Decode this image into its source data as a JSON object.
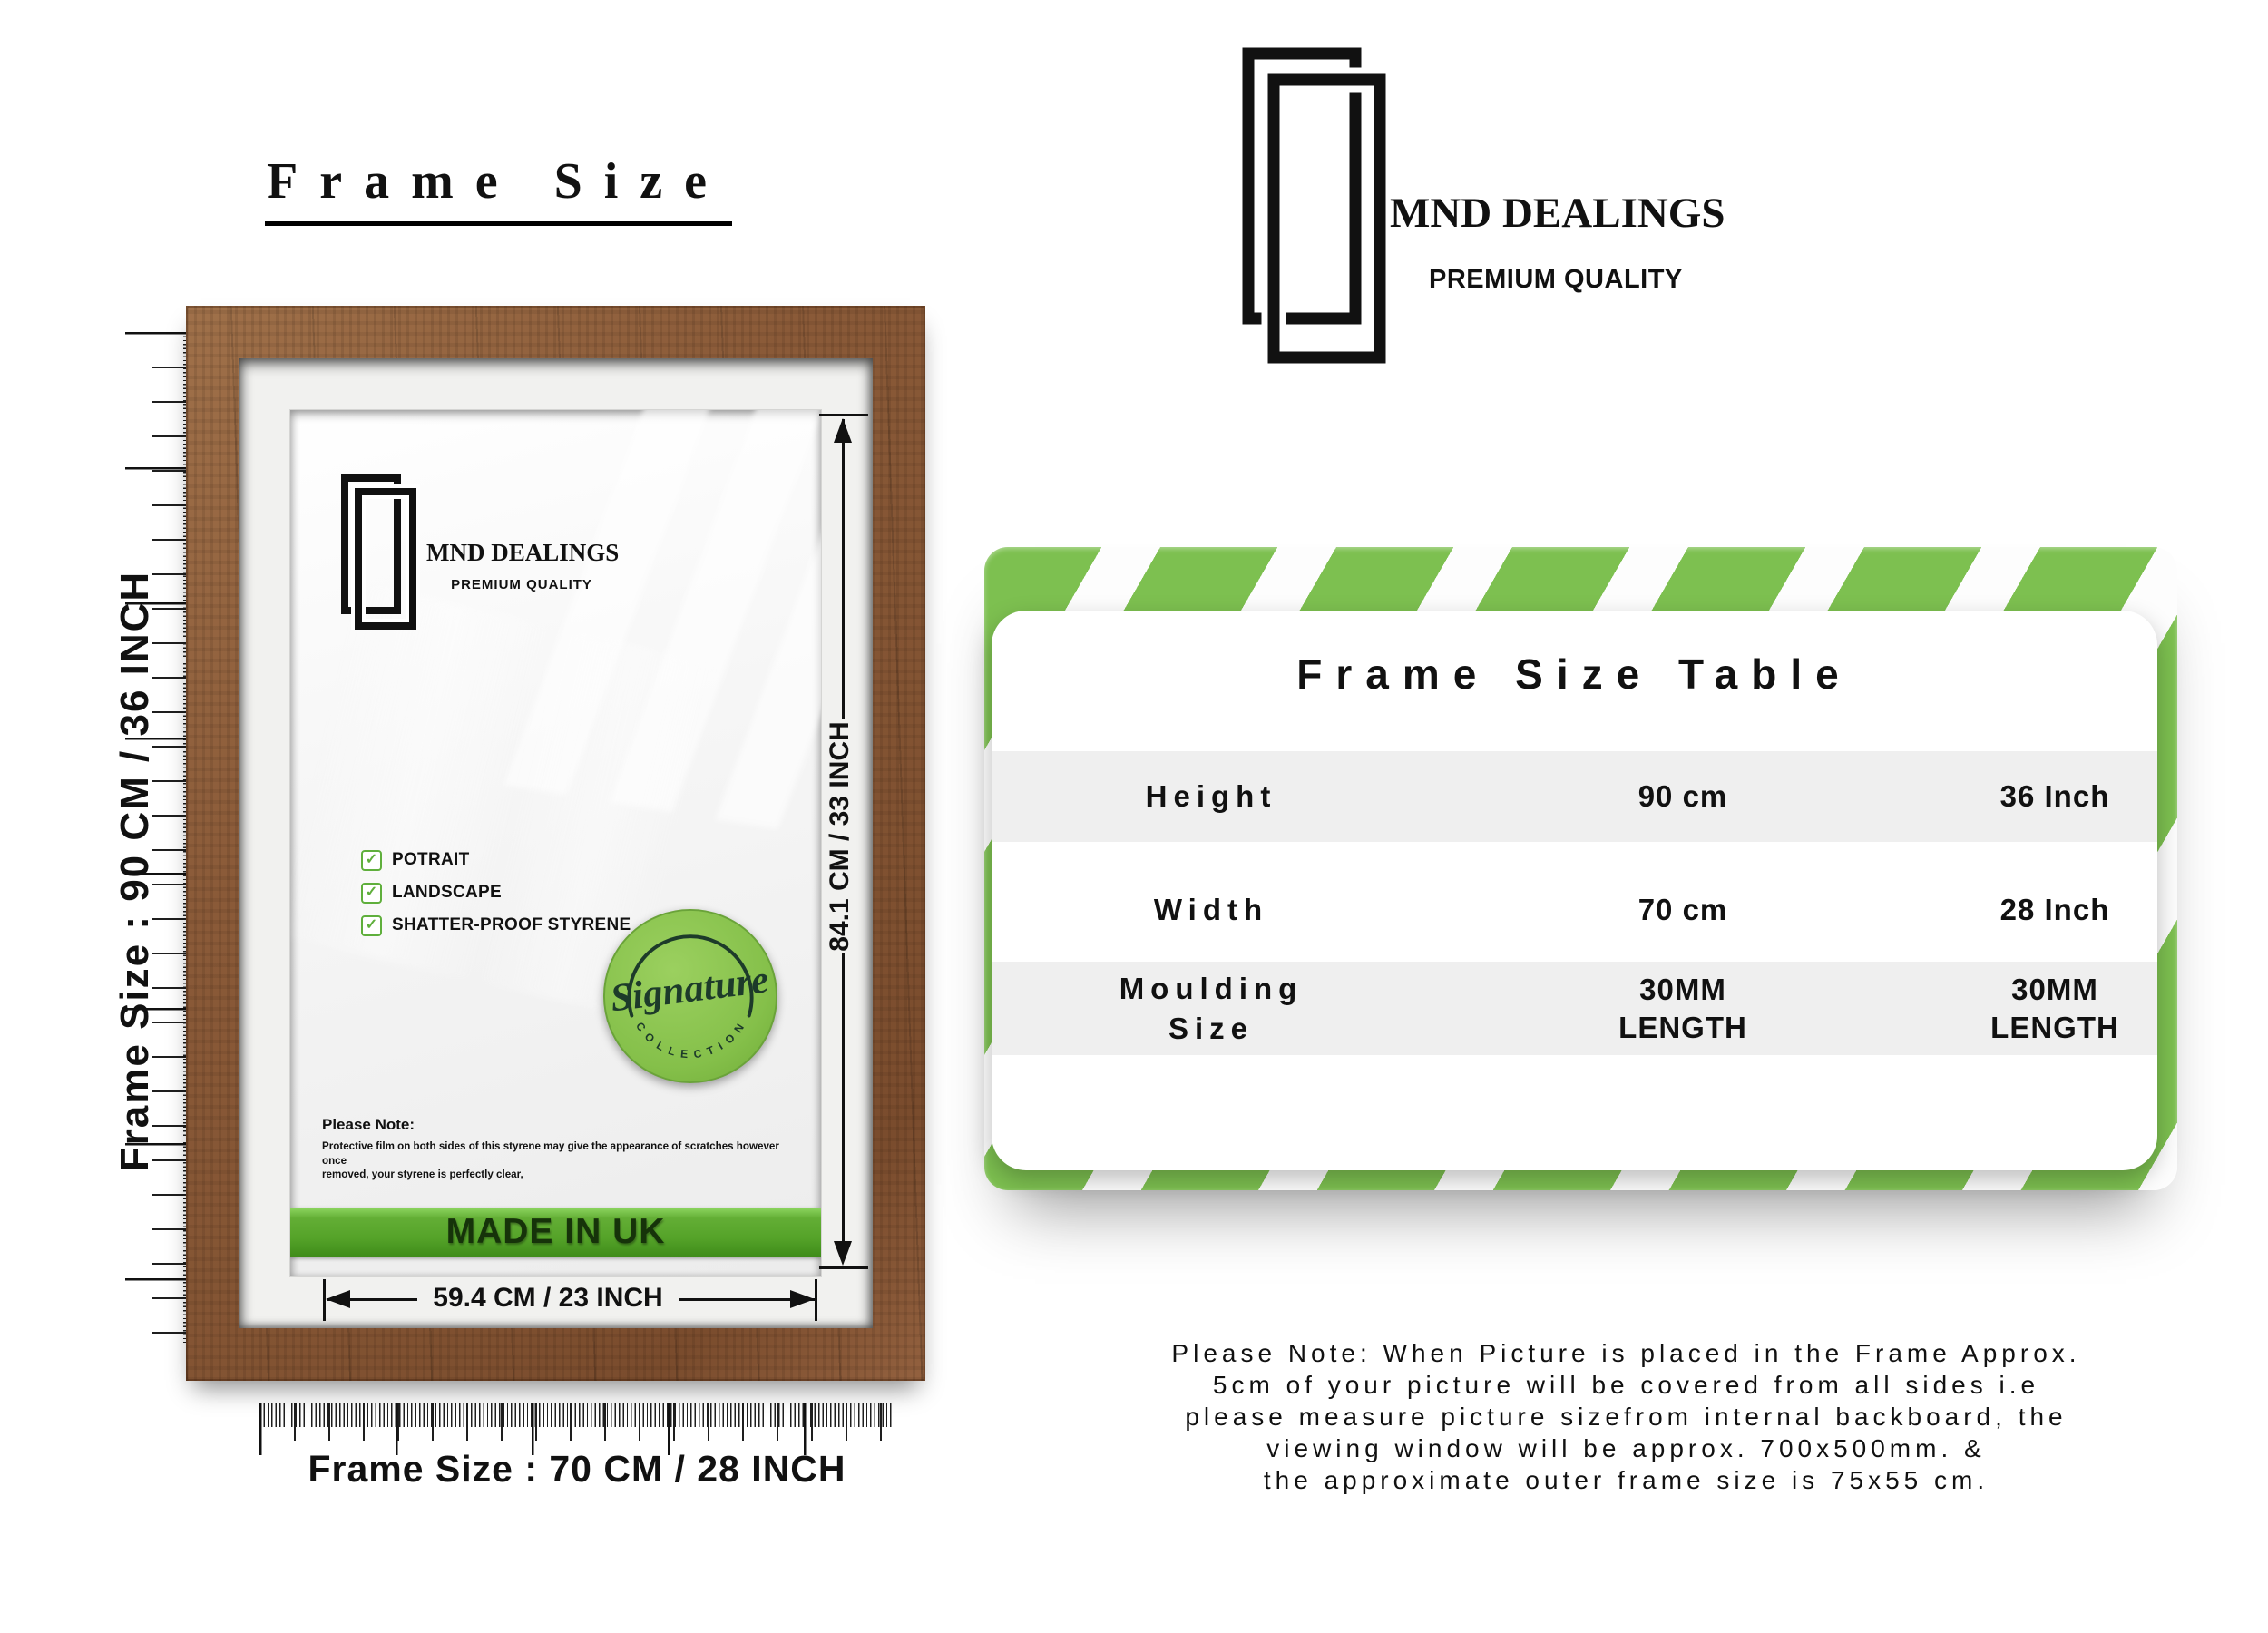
{
  "header": {
    "title": "Frame Size"
  },
  "brand": {
    "name": "MND DEALINGS",
    "tagline": "PREMIUM QUALITY"
  },
  "frame": {
    "features": [
      "POTRAIT",
      "LANDSCAPE",
      "SHATTER-PROOF STYRENE"
    ],
    "checkmark": "✓",
    "badge": {
      "script": "Signature",
      "curved": "C O L L E C T I O N"
    },
    "note": {
      "heading": "Please Note:",
      "body1": "Protective film on both sides of this styrene may give the appearance of scratches however once",
      "body2": "removed, your styrene is perfectly clear,"
    },
    "made_in": "MADE IN UK",
    "dims": {
      "height": "84.1 CM / 33 INCH",
      "width": "59.4 CM / 23 INCH"
    }
  },
  "rulers": {
    "left_label": "Frame Size : 90 CM / 36 INCH",
    "bottom_label": "Frame Size : 70 CM / 28 INCH"
  },
  "table": {
    "title": "Frame Size Table",
    "rows": [
      {
        "label": "Height",
        "cm": "90 cm",
        "inch": "36 Inch"
      },
      {
        "label": "Width",
        "cm": "70 cm",
        "inch": "28 Inch"
      },
      {
        "label": "Moulding Size",
        "cm": "30MM LENGTH",
        "inch": "30MM LENGTH"
      }
    ]
  },
  "footer": {
    "lines": [
      "Please Note: When Picture is placed in the Frame Approx.",
      "5cm of your picture will be covered from all sides i.e",
      "please measure picture sizefrom internal backboard, the",
      "viewing window will be approx. 700x500mm. &",
      "the approximate outer frame size is 75x55 cm."
    ]
  },
  "colors": {
    "accent_green": "#7dc050",
    "banner_green_dark": "#3f8c1a",
    "badge_green": "#8cc653",
    "wood_brown": "#8a5a38",
    "row_gray": "#efefef",
    "text_black": "#111111"
  }
}
